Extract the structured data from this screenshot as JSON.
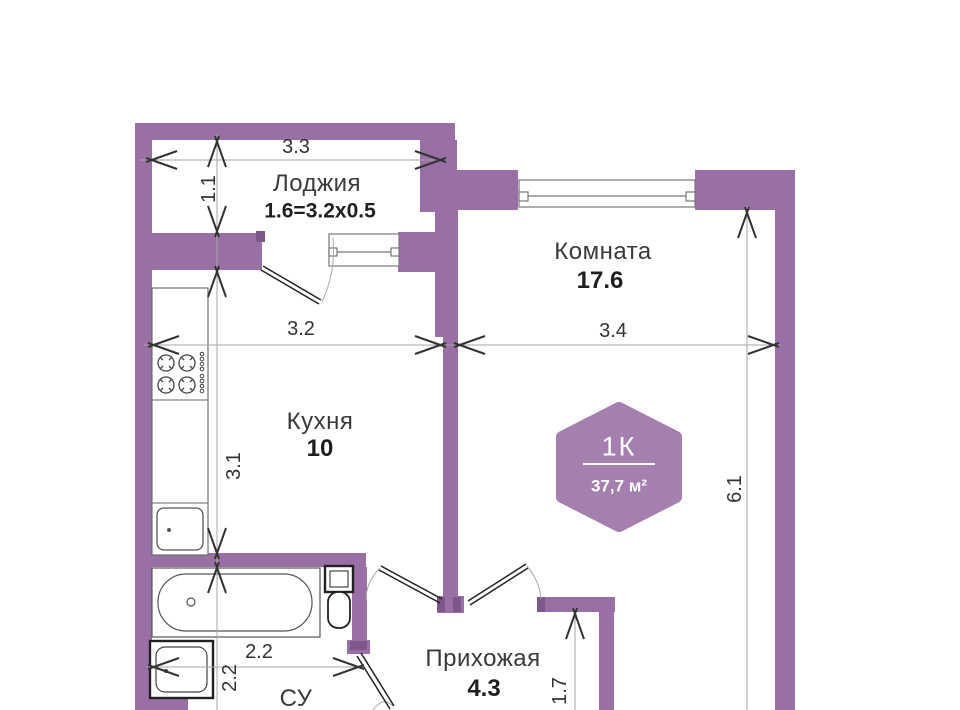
{
  "plan": {
    "rooms": {
      "loggia": {
        "name": "Лоджия",
        "size": "1.6=3.2x0.5"
      },
      "living": {
        "name": "Комната",
        "area": "17.6"
      },
      "kitchen": {
        "name": "Кухня",
        "area": "10"
      },
      "hallway": {
        "name": "Прихожая",
        "area": "4.3"
      },
      "bathroom": {
        "name": "СУ"
      }
    },
    "badge": {
      "type": "1К",
      "area": "37,7 м²"
    },
    "dimensions": {
      "loggia_width": "3.3",
      "loggia_depth": "1.1",
      "kitchen_width": "3.2",
      "kitchen_height": "3.1",
      "room_width": "3.4",
      "room_height": "6.1",
      "bathroom_width": "2.2",
      "bathroom_height": "2.2",
      "hallway_height": "1.7"
    },
    "colors": {
      "wall": "#9a6fa5",
      "wall_dark": "#7e578b",
      "badge": "#a57fb0",
      "dimension_line": "#a6a6a6",
      "arrow": "#333333",
      "text": "#3a3a3a",
      "fixture_stroke": "#555555"
    }
  }
}
